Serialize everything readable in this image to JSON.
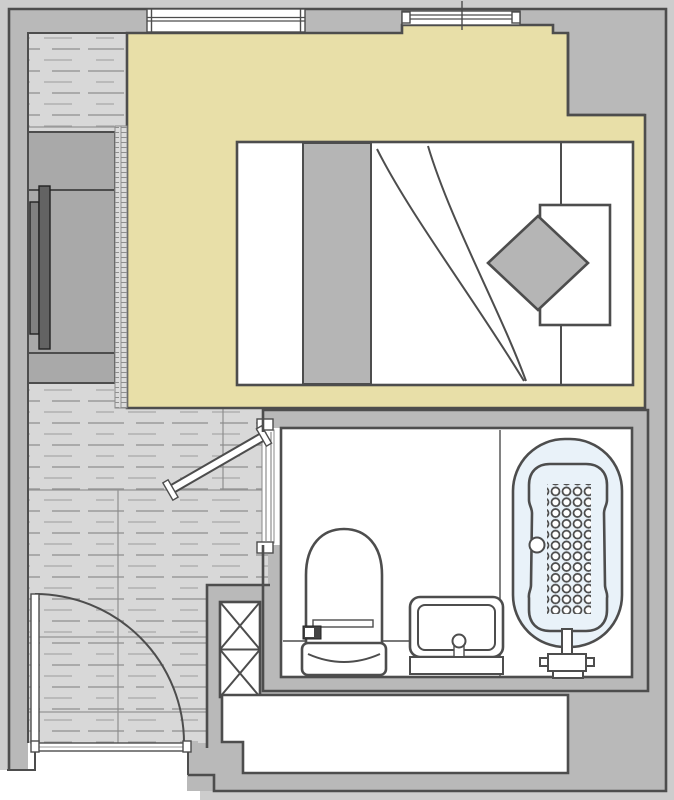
{
  "title": "apartment-floor-plan",
  "canvas": {
    "width": 674,
    "height": 800
  },
  "colors": {
    "margin": "#cdcdcd",
    "wall": "#b9b9b9",
    "line": "#4d4d4d",
    "bedroomFloor": "#e8dfa8",
    "woodFloor": "#d8d8d8",
    "plankDash": "#9a9a9a",
    "seam": "#8a8a8a",
    "softGray": "#b5b5b5",
    "closet": "#a9a9a9",
    "darkBar": "#636363",
    "darkBar2": "#808080",
    "tubBlue": "#e9f2f9",
    "panelDark": "#444444"
  },
  "rooms": [
    {
      "id": "bedroom",
      "floor": "beige"
    },
    {
      "id": "hallway",
      "floor": "wood-plank"
    },
    {
      "id": "bathroom",
      "floor": "white-tile"
    }
  ],
  "fixtures": [
    "double-bed",
    "duvet-runner",
    "pillow",
    "diamond-cushion",
    "wardrobe",
    "wardrobe-sliding-panels",
    "door-track-strip",
    "window-top-left",
    "window-top-right",
    "entry-door-swing",
    "bathroom-door-open-leaf",
    "toilet",
    "toilet-control-panel",
    "vanity-sink",
    "bathtub",
    "tub-antislip-dots",
    "tub-drain",
    "tub-faucet",
    "service-shaft-x",
    "rear-alcove"
  ],
  "tub_dots": {
    "columns": 4,
    "rows": 12
  },
  "shaft_sections": 2,
  "windows": {
    "left_glazing_lines": 2,
    "right_glazing_lines": 2
  }
}
